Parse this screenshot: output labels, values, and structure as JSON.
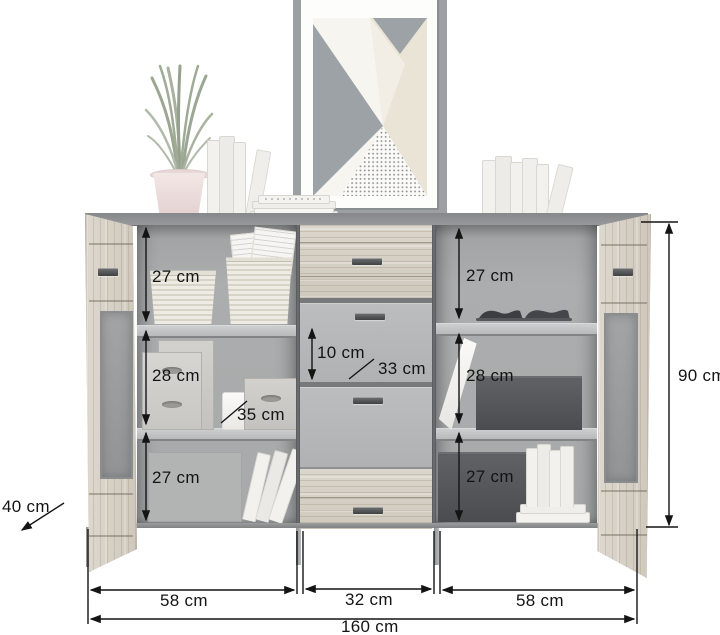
{
  "diagram": {
    "title": "sideboard-dimension-diagram",
    "unit": "cm",
    "dims": {
      "total_width": "160 cm",
      "height": "90 cm",
      "depth": "40 cm",
      "left_width": "58 cm",
      "middle_width": "32 cm",
      "right_width": "58 cm",
      "left_comp_top": "27 cm",
      "left_comp_mid": "28 cm",
      "left_comp_bottom": "27 cm",
      "right_comp_top": "27 cm",
      "right_comp_mid": "28 cm",
      "right_comp_bottom": "27 cm",
      "drawer_height": "10 cm",
      "drawer_depth": "33 cm",
      "shelf_depth": "35 cm"
    },
    "palette": {
      "annotation": "#141414",
      "wood": "#d7d2c8",
      "carcass_gray": "#97999b",
      "interior_gray": "#a9abac",
      "art_gray": "#9ca2a6",
      "art_cream": "#eae4d7",
      "pot_pink": "#eddfde"
    }
  }
}
